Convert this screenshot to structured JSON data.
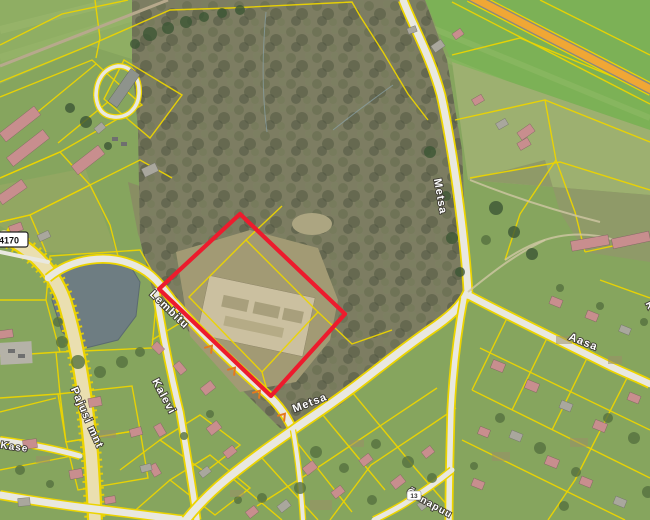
{
  "map": {
    "street_labels": [
      {
        "text": "Metsa"
      },
      {
        "text": "Metsa"
      },
      {
        "text": "Aasa"
      },
      {
        "text": "Lembitu"
      },
      {
        "text": "Kalevi"
      },
      {
        "text": "Pajusi mnt"
      },
      {
        "text": "Õunapuu"
      },
      {
        "text": "Kase"
      },
      {
        "text": "R"
      }
    ],
    "road_badge": {
      "text": "4170"
    },
    "house_numbers": [
      {
        "text": "13"
      }
    ]
  },
  "colors": {
    "cadastral_yellow": "#ecd400",
    "boundary_red": "#ed1b2d",
    "highway_orange": "#f0a735",
    "road_cream": "#eadfb0",
    "road_white": "#e9e8e0",
    "pond_gray": "#6e7d82",
    "forest_base": "#7d7d62",
    "roof_pink": "#c88e8e",
    "culvert_orange": "#e5791e",
    "field_green": "#86a55e",
    "field_bright": "#7cb156",
    "label_halo": "#3d3a33"
  }
}
